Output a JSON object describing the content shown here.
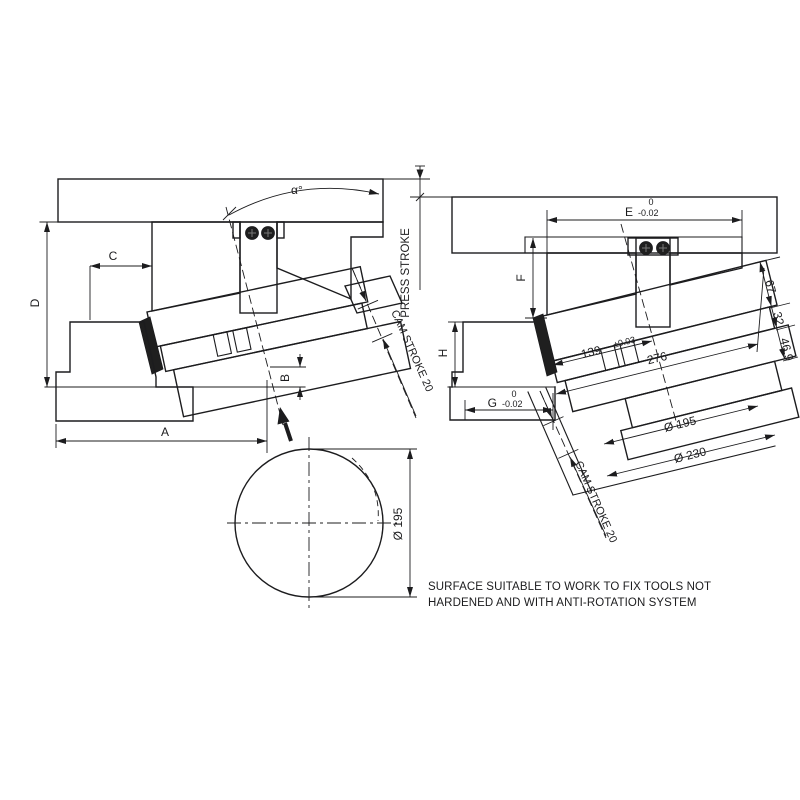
{
  "drawing_title": "Aerial cam unit dimensional drawing",
  "left_view": {
    "angle_label": "α°",
    "press_stroke_label": "PRESS STROKE",
    "cam_stroke_label": "CAM STROKE 20",
    "dim_a": "A",
    "dim_b": "B",
    "dim_c": "C",
    "dim_d": "D"
  },
  "right_view": {
    "dim_e": "E",
    "dim_e_tol_upper": "0",
    "dim_e_tol_lower": "-0.02",
    "dim_f": "F",
    "dim_g": "G",
    "dim_g_tol_upper": "0",
    "dim_g_tol_lower": "-0.02",
    "dim_h": "H",
    "dim_139": "139",
    "dim_139_tol": "±0.03",
    "dim_276": "276",
    "dia_195": "Ø  195",
    "dia_230": "Ø  230",
    "dim_67": "67",
    "dim_32": "32",
    "dim_469": "46.9",
    "cam_stroke_label": "CAM STROKE 20"
  },
  "bottom_view": {
    "dia_label": "Ø  195"
  },
  "note": {
    "line1": "SURFACE SUITABLE TO WORK TO FIX TOOLS NOT",
    "line2": "HARDENED AND WITH ANTI-ROTATION SYSTEM"
  },
  "colors": {
    "line": "#1c1c1e",
    "background": "#ffffff"
  }
}
